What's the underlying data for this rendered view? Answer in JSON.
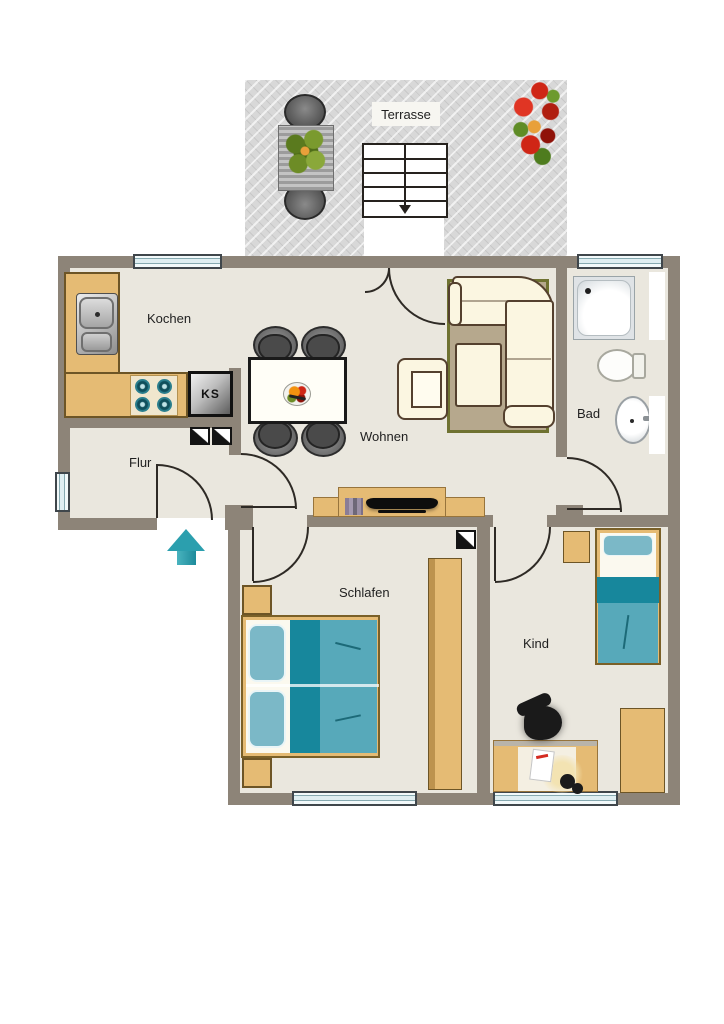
{
  "rooms": {
    "terrasse": {
      "label": "Terrasse"
    },
    "kochen": {
      "label": "Kochen"
    },
    "wohnen": {
      "label": "Wohnen"
    },
    "bad": {
      "label": "Bad"
    },
    "flur": {
      "label": "Flur"
    },
    "schlafen": {
      "label": "Schlafen"
    },
    "kind": {
      "label": "Kind"
    }
  },
  "appliances": {
    "fridge_label": "KS"
  },
  "symbols": {
    "entry_arrow": "arrow-up",
    "stairs_direction": "arrow-down",
    "corner_markers": "diagonal-split-square"
  },
  "colors": {
    "wall": "#8d8478",
    "floor": "#eae7de",
    "tan": "#e5bb74",
    "tanline": "#6d5526",
    "tealdark": "#17879c",
    "tealmid": "#57a9ba",
    "teallight": "#7bb8c7",
    "glass": "#dfeef1",
    "frame": "#3f464b",
    "cream": "#fbf6e1",
    "creamline": "#54402e",
    "rug": "#b6a88d",
    "rugline": "#6f7231",
    "line": "#2e2a25",
    "arrow": "#2b9fae",
    "terrace": "#d8d8d8",
    "chairgray": "#4a4a4a",
    "label": "#1f1f1f"
  }
}
